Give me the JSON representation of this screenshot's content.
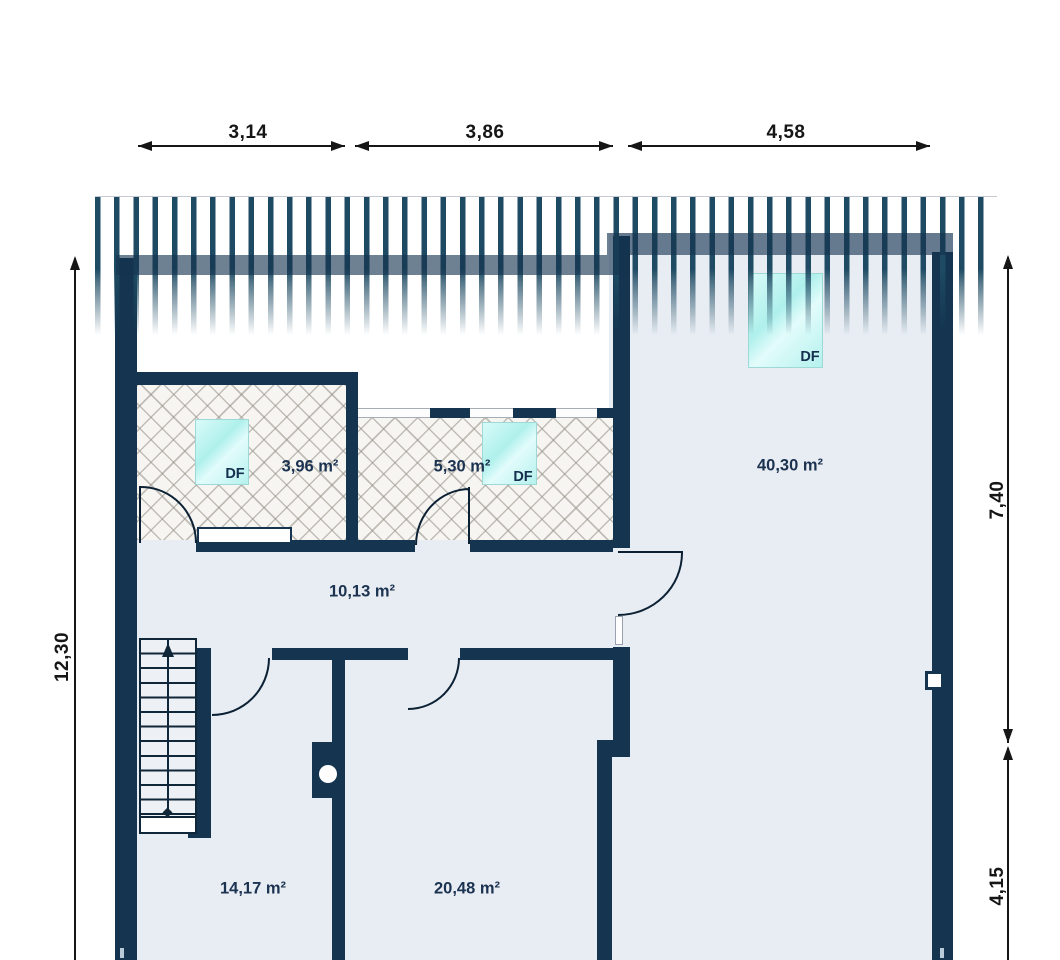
{
  "plan": {
    "title": "attic floor plan",
    "dimensions_top": [
      "3,14",
      "3,86",
      "4,58"
    ],
    "dimension_left": "12,30",
    "dimensions_right": [
      "7,40",
      "4,15"
    ],
    "rooms": {
      "attic_left": {
        "area": "3,96 m²",
        "skylight_label": "DF"
      },
      "attic_mid": {
        "area": "5,30 m²",
        "skylight_label": "DF"
      },
      "big_room": {
        "area": "40,30 m²",
        "skylight_label": "DF"
      },
      "hallway": {
        "area": "10,13 m²"
      },
      "room_bottom_left": {
        "area": "14,17 m²"
      },
      "room_bottom_middle": {
        "area": "20,48 m²"
      }
    },
    "colors": {
      "wall": "#14344f",
      "floor_fill": "#e8edf3",
      "roof_hatch_stripe": "#1e4b63",
      "skylight_cyan": "#b4f1ee",
      "hatched_room_bg": "#f6f5f2",
      "dimension_text": "#161616"
    }
  }
}
